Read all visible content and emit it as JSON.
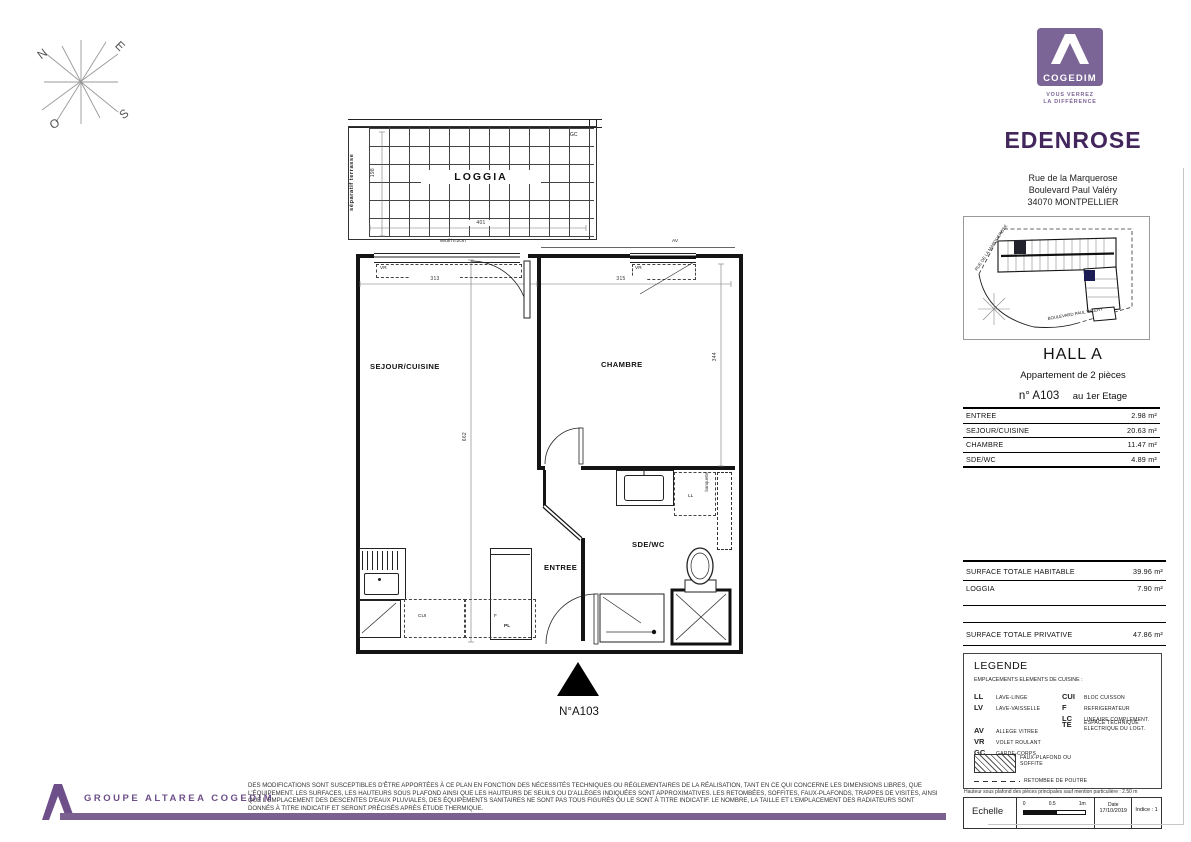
{
  "colors": {
    "brand_purple": "#7b6496",
    "title_purple": "#42265c",
    "footer_purple": "#6e4f8a",
    "bar_purple": "#7a618f"
  },
  "compass": {
    "n": "N",
    "e": "E",
    "s": "S",
    "o": "O"
  },
  "brand": {
    "name": "COGEDIM",
    "tagline1": "VOUS VERREZ",
    "tagline2": "LA DIFFÉRENCE"
  },
  "project": {
    "name": "EDENROSE",
    "address1": "Rue de la Marquerose",
    "address2": "Boulevard Paul Valéry",
    "address3": "34070 MONTPELLIER"
  },
  "site_plan": {
    "street_left": "RUE DE LA MARQUEROSE",
    "street_bottom": "BOULEVARD PAUL VALÉRY"
  },
  "unit": {
    "hall": "HALL A",
    "type": "Appartement de 2 pièces",
    "number": "n° A103",
    "floor": "au 1er Etage",
    "plan_ref": "N°A103"
  },
  "plan": {
    "loggia": "LOGGIA",
    "sejour": "SEJOUR/CUISINE",
    "chambre": "CHAMBRE",
    "entree": "ENTREE",
    "sde": "SDE/WC",
    "separatif": "séparatif terrasse",
    "gc": "GC",
    "seuil": "seuil h=2cm",
    "vr": "VR",
    "av": "AV",
    "ll": "LL",
    "cui": "CUI",
    "f": "F",
    "pl": "PL",
    "banquette": "banquette",
    "dim_loggia_w": "401",
    "dim_loggia_d": "198",
    "dim_sejour_w": "313",
    "dim_chambre_w": "315",
    "dim_depth": "662",
    "dim_chambre_d": "344"
  },
  "areas": {
    "rows": [
      {
        "label": "ENTREE",
        "value": "2.98 m²"
      },
      {
        "label": "SEJOUR/CUISINE",
        "value": "20.63 m²"
      },
      {
        "label": "CHAMBRE",
        "value": "11.47 m²"
      },
      {
        "label": "SDE/WC",
        "value": "4.89 m²"
      }
    ],
    "habitable": {
      "label": "SURFACE TOTALE HABITABLE",
      "value": "39.96 m²"
    },
    "loggia": {
      "label": "LOGGIA",
      "value": "7.90 m²"
    },
    "privative": {
      "label": "SURFACE TOTALE PRIVATIVE",
      "value": "47.86 m²"
    }
  },
  "legend": {
    "title": "LEGENDE",
    "subtitle": "EMPLACEMENTS ELEMENTS DE CUISINE :",
    "col1": [
      {
        "abbr": "LL",
        "label": "LAVE-LINGE"
      },
      {
        "abbr": "LV",
        "label": "LAVE-VAISSELLE"
      },
      {
        "abbr": "AV",
        "label": "ALLEGE VITREE"
      },
      {
        "abbr": "VR",
        "label": "VOLET ROULANT"
      },
      {
        "abbr": "GC",
        "label": "GARDE-CORPS"
      }
    ],
    "col2": [
      {
        "abbr": "CUI",
        "label": "BLOC CUISSON"
      },
      {
        "abbr": "F",
        "label": "REFRIGERATEUR"
      },
      {
        "abbr": "LC",
        "label": "LINEAIRE COMPLEMENT."
      },
      {
        "abbr": "TE",
        "label": "ESPACE TECHNIQUE ELECTRIQUE DU LOGT."
      }
    ],
    "hatch_label": "FAUX-PLAFOND OU SOFFITE",
    "dash_label": "RETOMBEE DE POUTRE"
  },
  "notes": {
    "ceiling": "Hauteur sous plafond des pièces principales sauf mention particulière : 2.50 m"
  },
  "scale": {
    "label": "Echelle",
    "t0": "0",
    "t05": "0.5",
    "t1": "1m",
    "date_label": "Date",
    "date_value": "17/10/2019",
    "indice": "Indice : 1"
  },
  "footer": {
    "brand": "GROUPE ALTAREA COGEDIM",
    "disclaimer": "DES MODIFICATIONS SONT SUSCEPTIBLES D'ÊTRE APPORTÉES À CE PLAN EN FONCTION DES NÉCESSITÉS TECHNIQUES OU RÉGLEMENTAIRES DE LA RÉALISATION, TANT EN CE QUI CONCERNE LES DIMENSIONS LIBRES, QUE L'ÉQUIPEMENT. LES SURFACES, LES HAUTEURS SOUS PLAFOND AINSI QUE LES HAUTEURS DE SEUILS OU D'ALLÈGES INDIQUÉES SONT APPROXIMATIVES. LES RETOMBÉES, SOFFITES, FAUX-PLAFONDS, TRAPPES DE VISITES, AINSI QUE L'EMPLACEMENT DES DESCENTES D'EAUX PLUVIALES, DES ÉQUIPEMENTS SANITAIRES NE SONT PAS TOUS FIGURÉS OU LE SONT À TITRE INDICATIF. LE NOMBRE, LA TAILLE ET L'EMPLACEMENT DES RADIATEURS SONT DONNÉS À TITRE INDICATIF ET SERONT PRÉCISÉS APRÈS ÉTUDE THERMIQUE."
  }
}
